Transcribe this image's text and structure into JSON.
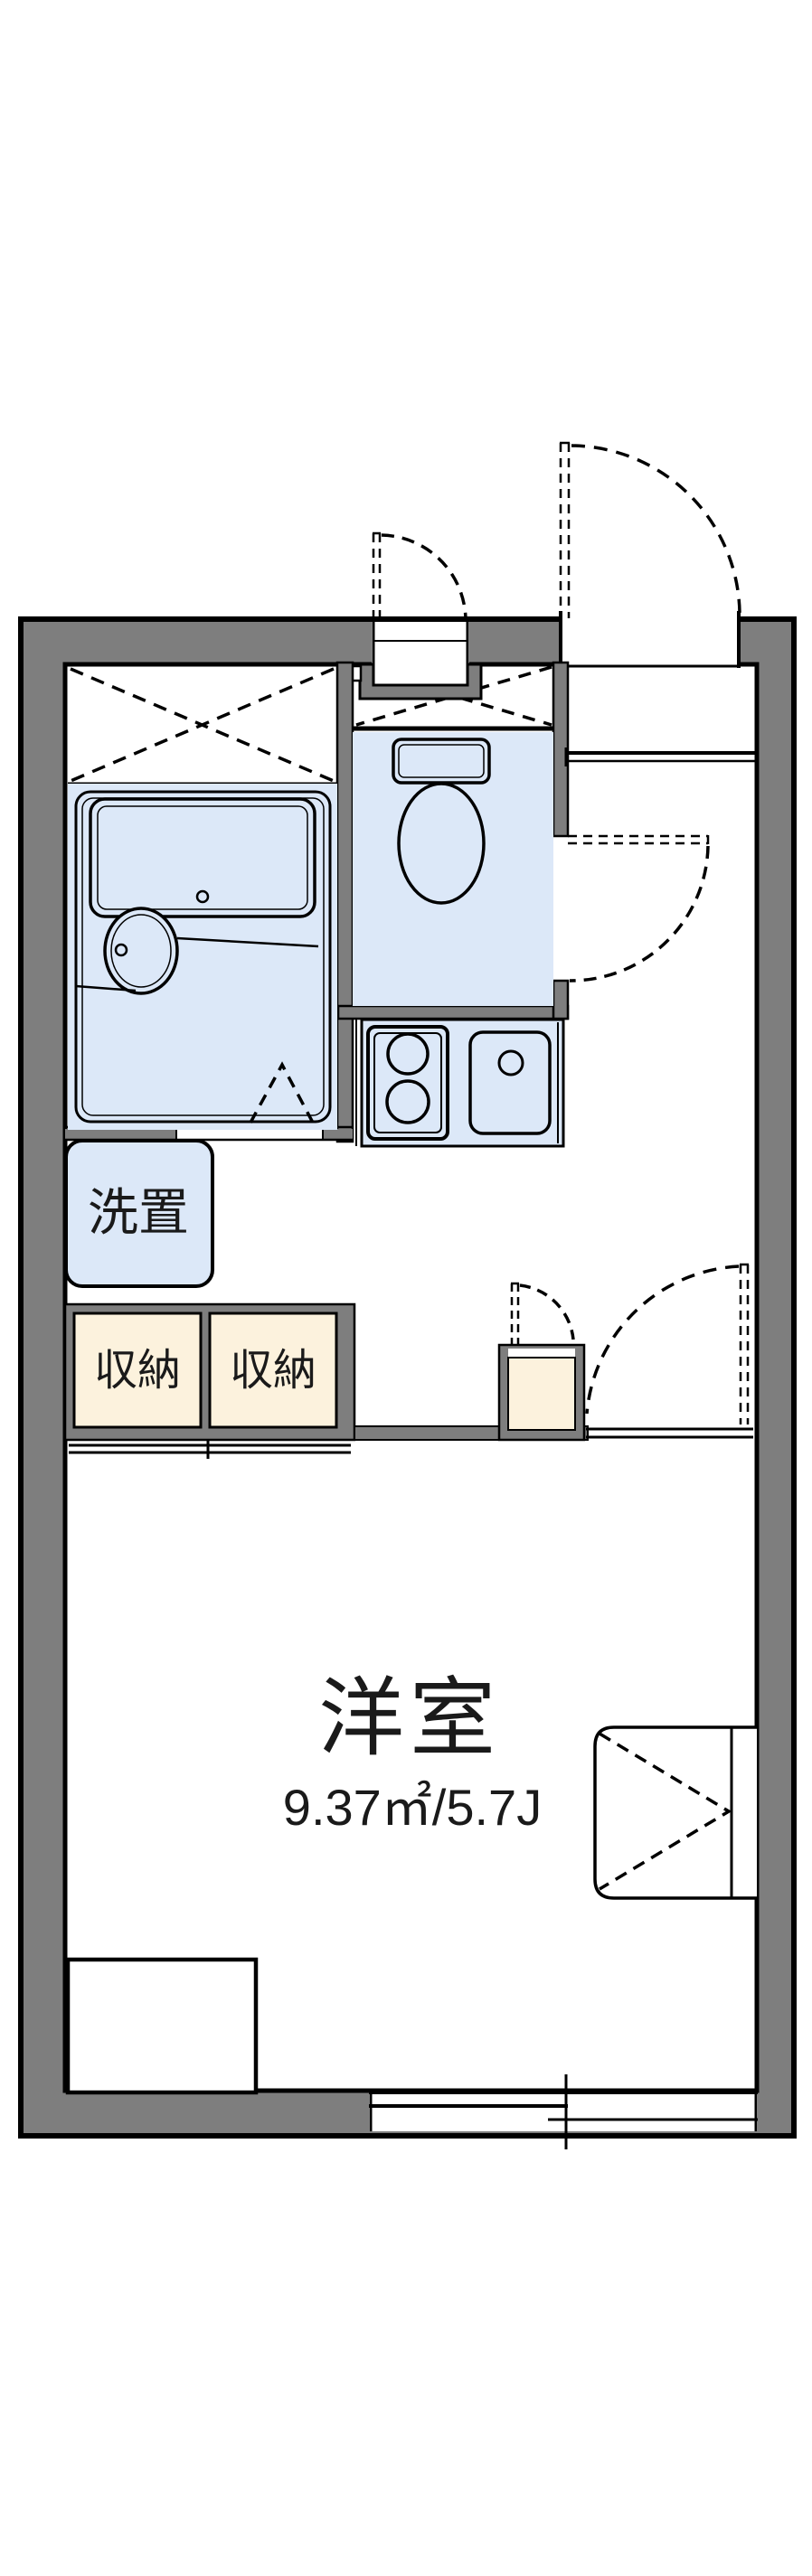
{
  "floor_plan": {
    "room": {
      "name": "洋室",
      "area": "9.37㎡/5.7J"
    },
    "washer": {
      "label": "洗置"
    },
    "storage_labels": [
      "収納",
      "収納"
    ],
    "colors": {
      "wall_gray": "#7e7e7e",
      "fixture_blue": "#dce8f8",
      "storage_cream": "#fcf2dd",
      "line_black": "#000000",
      "background": "#ffffff"
    }
  }
}
